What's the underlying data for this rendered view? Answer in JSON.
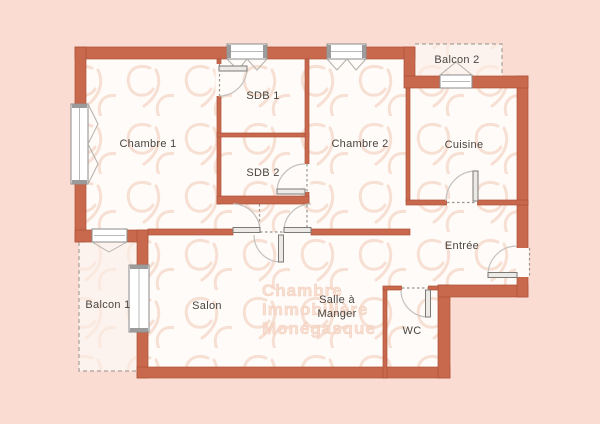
{
  "plan": {
    "type": "apartment-floor-plan",
    "colors": {
      "background": "#fbdcd2",
      "wall": "#c8694e",
      "wall_outline": "#ad5237",
      "room_fill": "#fefbf8",
      "balcony_fill": "#fdf3ee",
      "label_text": "#4a4540",
      "watermark_text": "#f8dccd"
    },
    "rooms": {
      "chambre1": "Chambre 1",
      "sdb1": "SDB 1",
      "sdb2": "SDB 2",
      "chambre2": "Chambre 2",
      "cuisine": "Cuisine",
      "balcon2": "Balcon 2",
      "entree": "Entrée",
      "balcon1": "Balcon 1",
      "salon": "Salon",
      "salle_a_manger_line1": "Salle à",
      "salle_a_manger_line2": "Manger",
      "wc": "WC"
    },
    "watermark": {
      "line1": "Chambre",
      "line2": "Immobilière",
      "line3": "Monégasque"
    }
  }
}
